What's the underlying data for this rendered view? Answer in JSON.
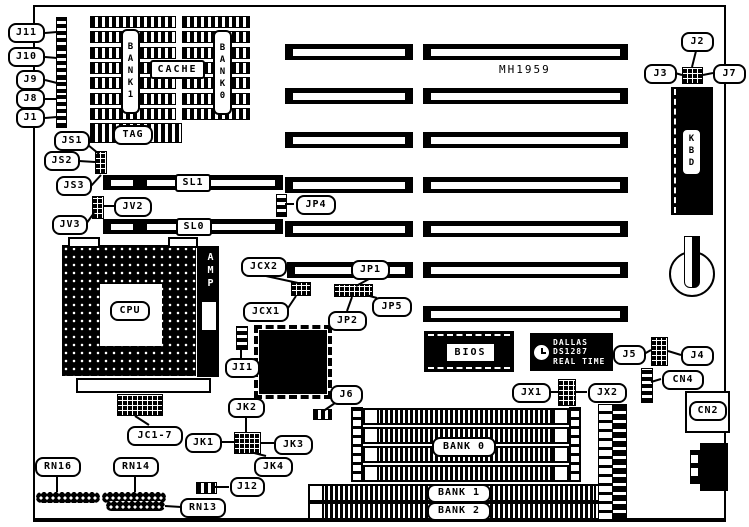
{
  "part_number": "MH1959",
  "callouts": {
    "j11": "J11",
    "j10": "J10",
    "j9": "J9",
    "j8": "J8",
    "j1": "J1",
    "js1": "JS1",
    "js2": "JS2",
    "js3": "JS3",
    "jv2": "JV2",
    "jv3": "JV3",
    "jp4": "JP4",
    "sl1": "SL1",
    "sl0": "SL0",
    "jcx2": "JCX2",
    "jcx1": "JCX1",
    "jp1": "JP1",
    "jp2": "JP2",
    "jp5": "JP5",
    "ji1": "JI1",
    "j6": "J6",
    "jk1": "JK1",
    "jk2": "JK2",
    "jk3": "JK3",
    "jk4": "JK4",
    "jc1_7": "JC1-7",
    "j12": "J12",
    "rn16": "RN16",
    "rn14": "RN14",
    "rn13": "RN13",
    "j2": "J2",
    "j3": "J3",
    "j7": "J7",
    "j5": "J5",
    "j4": "J4",
    "cn4": "CN4",
    "jx1": "JX1",
    "jx2": "JX2",
    "cn2": "CN2"
  },
  "chips": {
    "cpu": "CPU",
    "amp": "AMP",
    "kbd": "KBD",
    "bios": "BIOS",
    "cache": "CACHE",
    "tag": "TAG",
    "bank1_vertical": "BANK1",
    "bank0_vertical": "BANK0",
    "rtc_line1": "DALLAS",
    "rtc_line2": "DS1287",
    "rtc_line3": "REAL TIME"
  },
  "memory": {
    "bank0": "BANK 0",
    "bank1": "BANK 1",
    "bank2": "BANK 2"
  }
}
